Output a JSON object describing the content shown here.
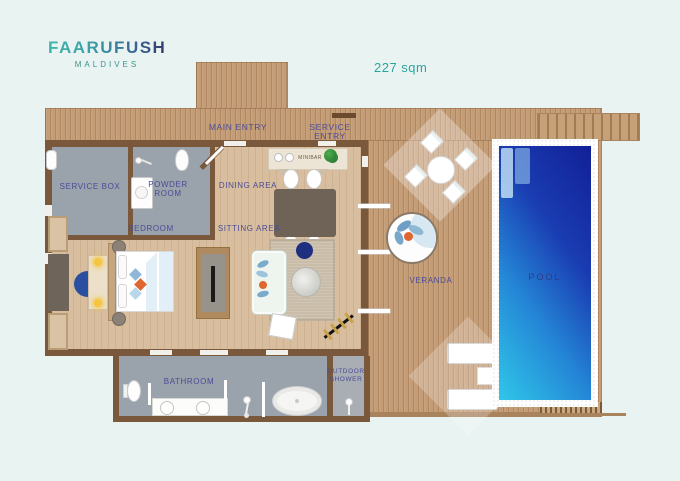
{
  "brand": {
    "name": "FAARUFUSHI",
    "subtitle": "MALDIVES"
  },
  "area_label": "227 sqm",
  "labels": {
    "main_entry": "MAIN ENTRY",
    "service_entry": "SERVICE ENTRY",
    "service_box": "SERVICE BOX",
    "powder_room": "POWDER ROOM",
    "dining_area": "DINING AREA",
    "minibar": "MINIBAR",
    "bedroom": "BEDROOM",
    "sitting_area": "SITTING AREA",
    "bathroom": "BATHROOM",
    "outdoor_shower": "OUTDOOR SHOWER",
    "veranda": "VERANDA",
    "pool": "POOL"
  },
  "colors": {
    "background": "#e9f4f2",
    "deck_wood": "#c49c76",
    "interior_wood": "#d8be9e",
    "wall_brown": "#7a583c",
    "room_gray": "#9aa2ab",
    "pool_cyan": "#2fc7e9",
    "pool_navy": "#14259a",
    "label_indigo": "#4a4c98",
    "brand_teal": "#3db5ab",
    "brand_navy": "#343c6e",
    "accent_orange": "#e0662f",
    "accent_blue": "#2a4fa0"
  }
}
